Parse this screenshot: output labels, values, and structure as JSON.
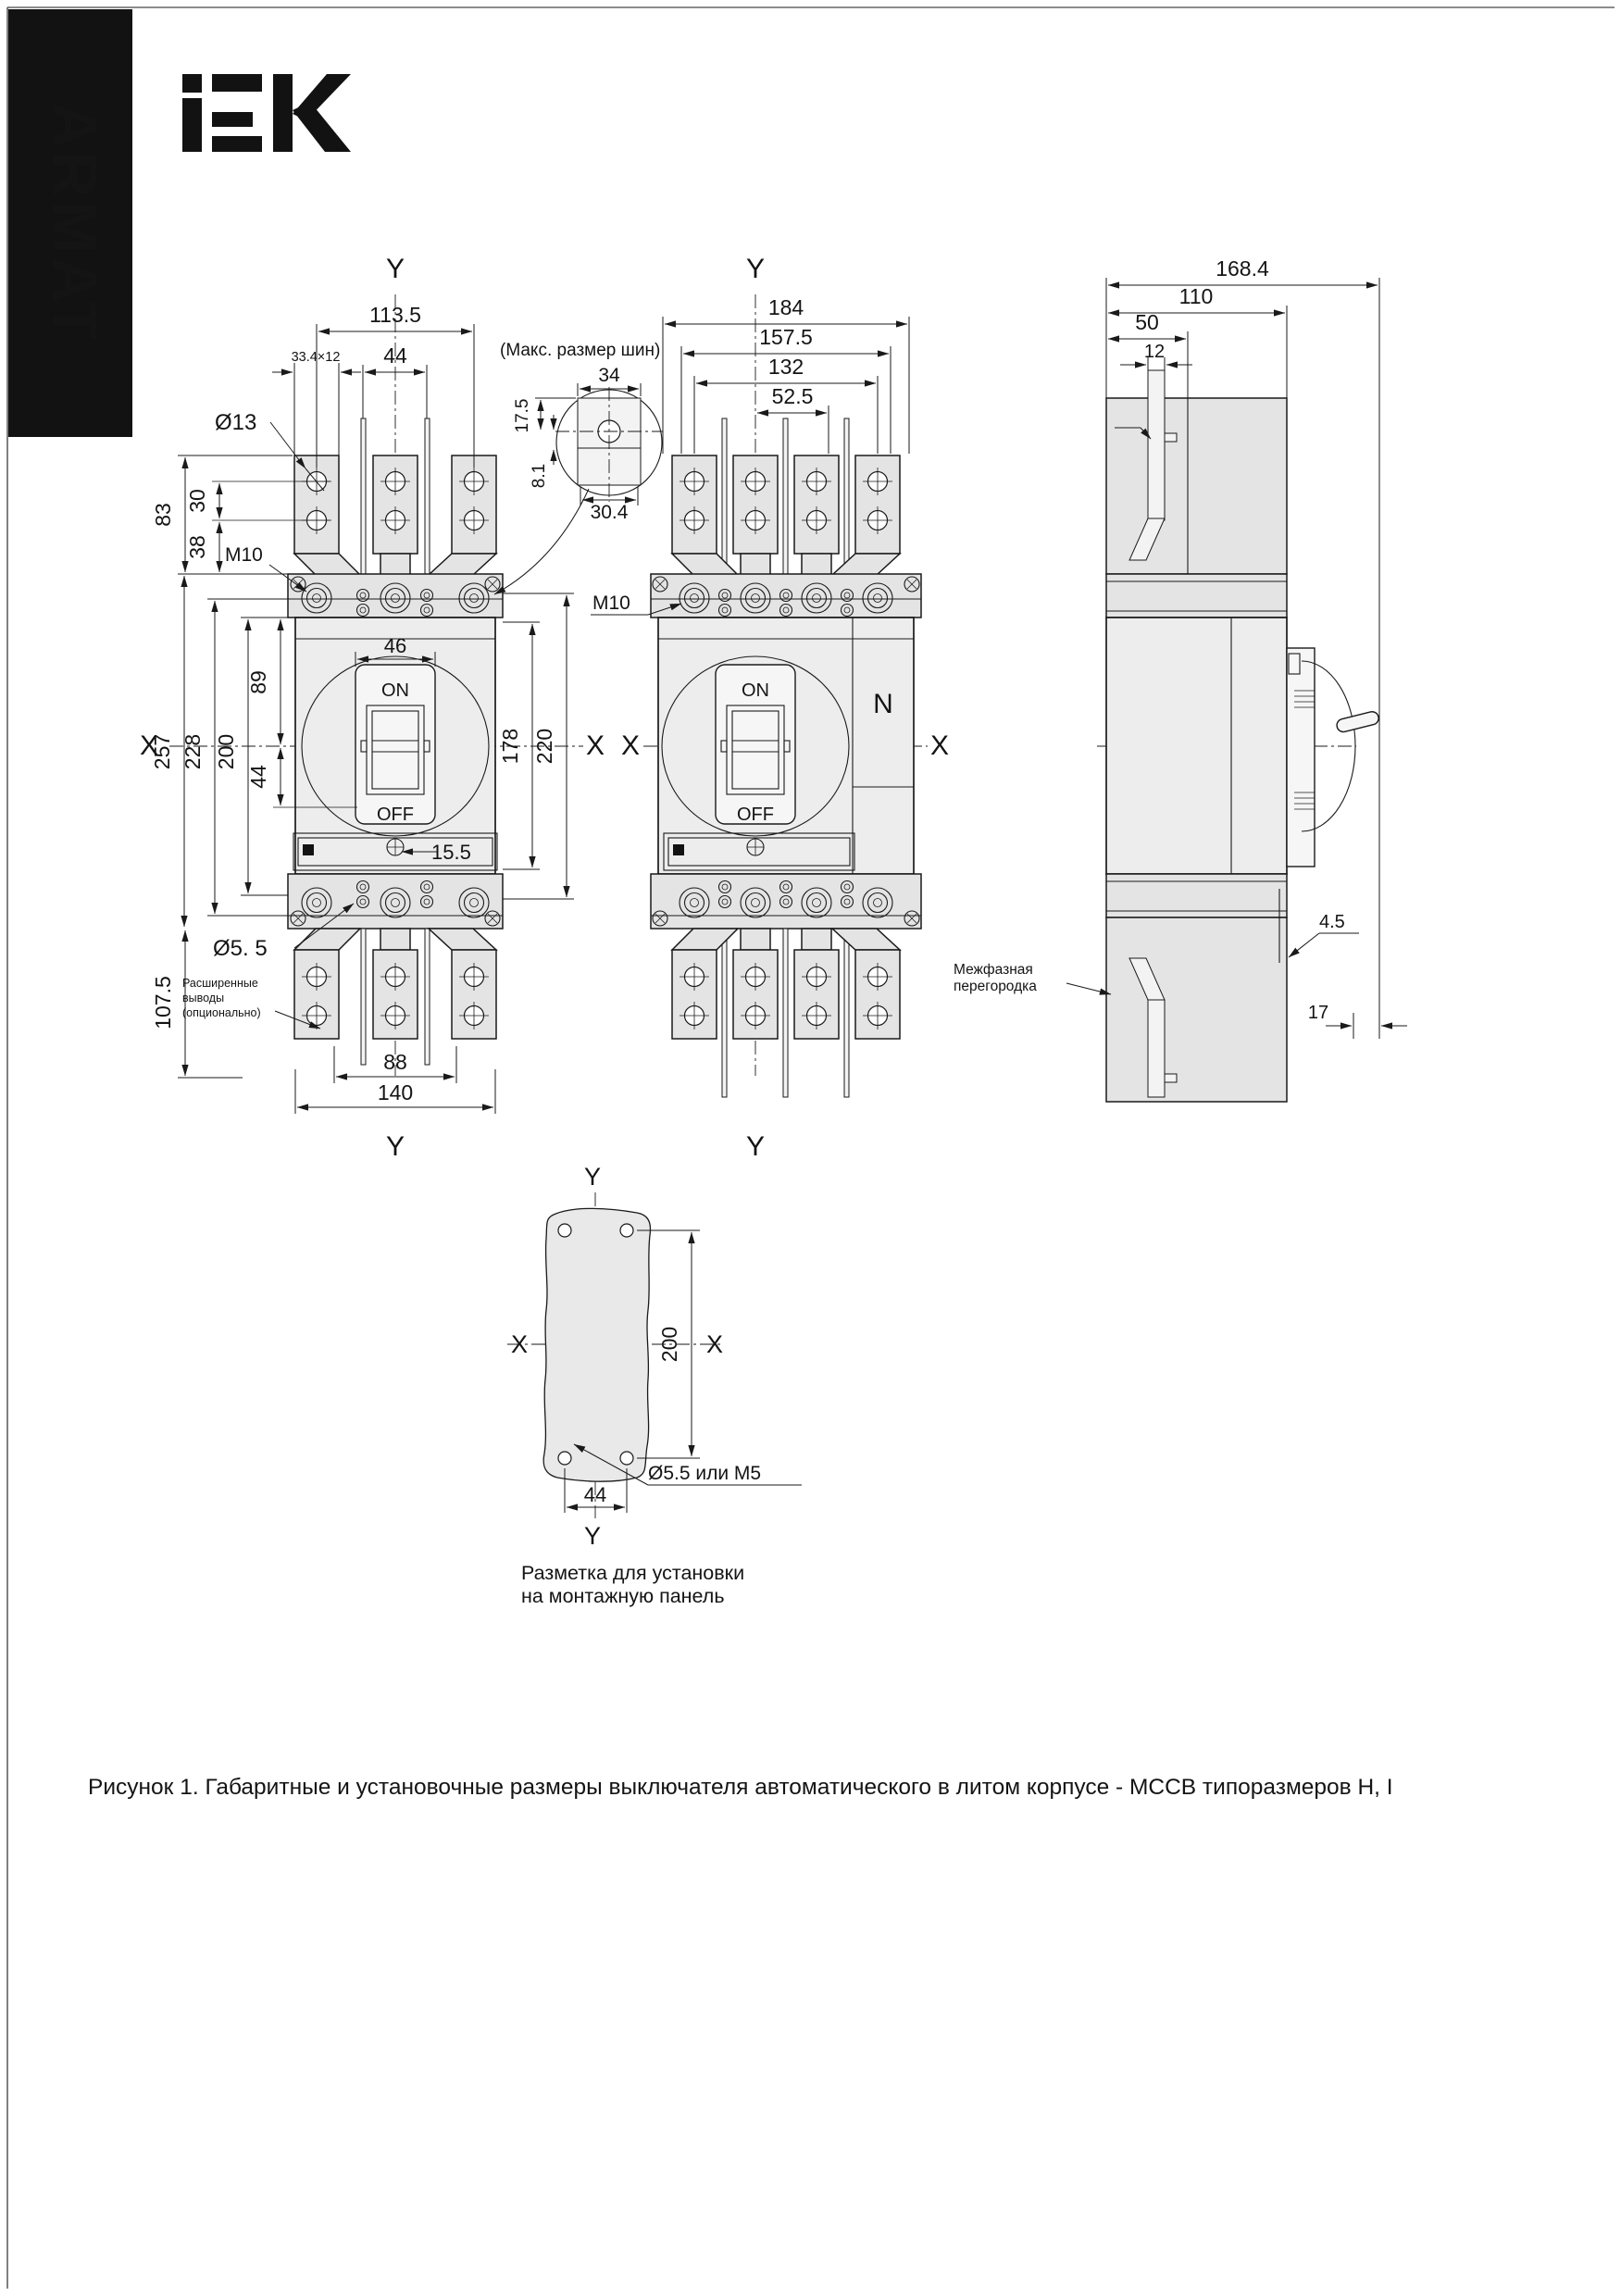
{
  "brand": {
    "banner_text": "ARMAT",
    "logo_text": "IEK"
  },
  "v1": {
    "y_top": "Y",
    "y_bottom": "Y",
    "x_left": "X",
    "x_right": "X",
    "dim_overall_w": "113.5",
    "dim_pole": "44",
    "dim_lug_section": "33.4×12",
    "lbl_hole_dia": "Ø13",
    "lbl_thread": "M10",
    "dim_lug_h": "83",
    "dim_hole_span": "30",
    "dim_hole_plate": "38",
    "dim_total_h": "257",
    "dim_body_h": "228",
    "dim_mount_h": "200",
    "dim_upper": "89",
    "dim_lower": "44",
    "dim_handle_w": "46",
    "lbl_on": "ON",
    "lbl_off": "OFF",
    "dim_window": "15.5",
    "dim_front_h": "178",
    "dim_cover_h": "220",
    "lbl_bottom_hole": "Ø5. 5",
    "dim_bottom_ext": "107.5",
    "note_ext_1": "Расширенные",
    "note_ext_2": "выводы",
    "note_ext_3": "(опционально)",
    "dim_bottom_span": "88",
    "dim_width": "140"
  },
  "bus": {
    "note": "(Макс. размер шин)",
    "dim_w": "34",
    "dim_top": "17.5",
    "dim_off": "8.1",
    "dim_slot": "30.4"
  },
  "v2": {
    "y_top": "Y",
    "y_bottom": "Y",
    "x_left": "X",
    "x_right": "X",
    "dim_w1": "184",
    "dim_w2": "157.5",
    "dim_w3": "132",
    "dim_w4": "52.5",
    "lbl_thread": "M10",
    "lbl_on": "ON",
    "lbl_off": "OFF",
    "lbl_neutral": "N"
  },
  "side": {
    "dim_depth": "168.4",
    "dim_body": "110",
    "dim_terminal": "50",
    "dim_bus": "12",
    "dim_offset": "26",
    "dim_gap": "4.5",
    "dim_handle": "17",
    "note_barrier_1": "Межфазная",
    "note_barrier_2": "перегородка"
  },
  "panel": {
    "y_top": "Y",
    "y_bottom": "Y",
    "x_left": "X",
    "x_right": "X",
    "dim_h": "200",
    "dim_w": "44",
    "lbl_hole": "Ø5.5 или M5",
    "caption_1": "Разметка для установки",
    "caption_2": "на монтажную панель"
  },
  "figure": {
    "caption": "Рисунок 1. Габаритные и установочные размеры выключателя автоматического в литом корпусе - MCCB типоразмеров  H, I"
  }
}
